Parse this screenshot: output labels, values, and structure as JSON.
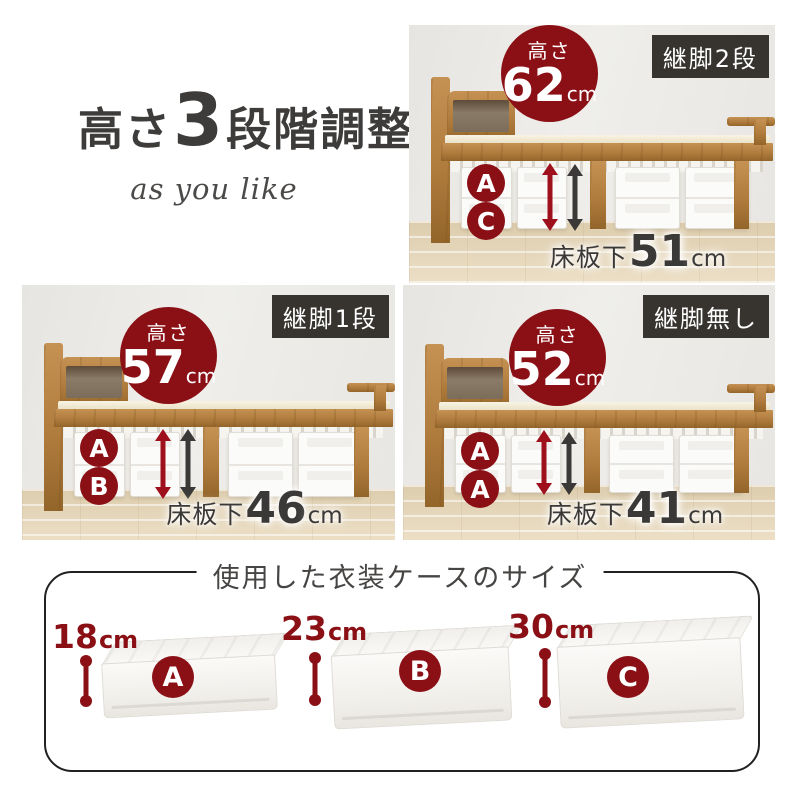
{
  "title": {
    "prefix": "高さ",
    "number": "3",
    "suffix": "段階調整",
    "subtitle": "as you like"
  },
  "panels": [
    {
      "badge": "継脚2段",
      "height_label": "高さ",
      "height_value": "62",
      "height_unit": "cm",
      "box_labels": [
        "A",
        "C"
      ],
      "clearance_label": "床板下",
      "clearance_value": "51",
      "clearance_unit": "cm"
    },
    {
      "badge": "継脚1段",
      "height_label": "高さ",
      "height_value": "57",
      "height_unit": "cm",
      "box_labels": [
        "A",
        "B"
      ],
      "clearance_label": "床板下",
      "clearance_value": "46",
      "clearance_unit": "cm"
    },
    {
      "badge": "継脚無し",
      "height_label": "高さ",
      "height_value": "52",
      "height_unit": "cm",
      "box_labels": [
        "A",
        "A"
      ],
      "clearance_label": "床板下",
      "clearance_value": "41",
      "clearance_unit": "cm"
    }
  ],
  "cases_section": {
    "title": "使用した衣装ケースのサイズ",
    "items": [
      {
        "label": "A",
        "height_value": "18",
        "height_unit": "cm"
      },
      {
        "label": "B",
        "height_value": "23",
        "height_unit": "cm"
      },
      {
        "label": "C",
        "height_value": "30",
        "height_unit": "cm"
      }
    ]
  },
  "colors": {
    "accent_red": "#8b1016",
    "arrow_red": "#9e111c",
    "arrow_gray": "#3a3937",
    "badge_bg": "#37342f",
    "text_dark": "#3c3a38",
    "wood": "#b07c3d",
    "floor_wood": "#e4d4b6",
    "wall": "#ebe9e5"
  }
}
